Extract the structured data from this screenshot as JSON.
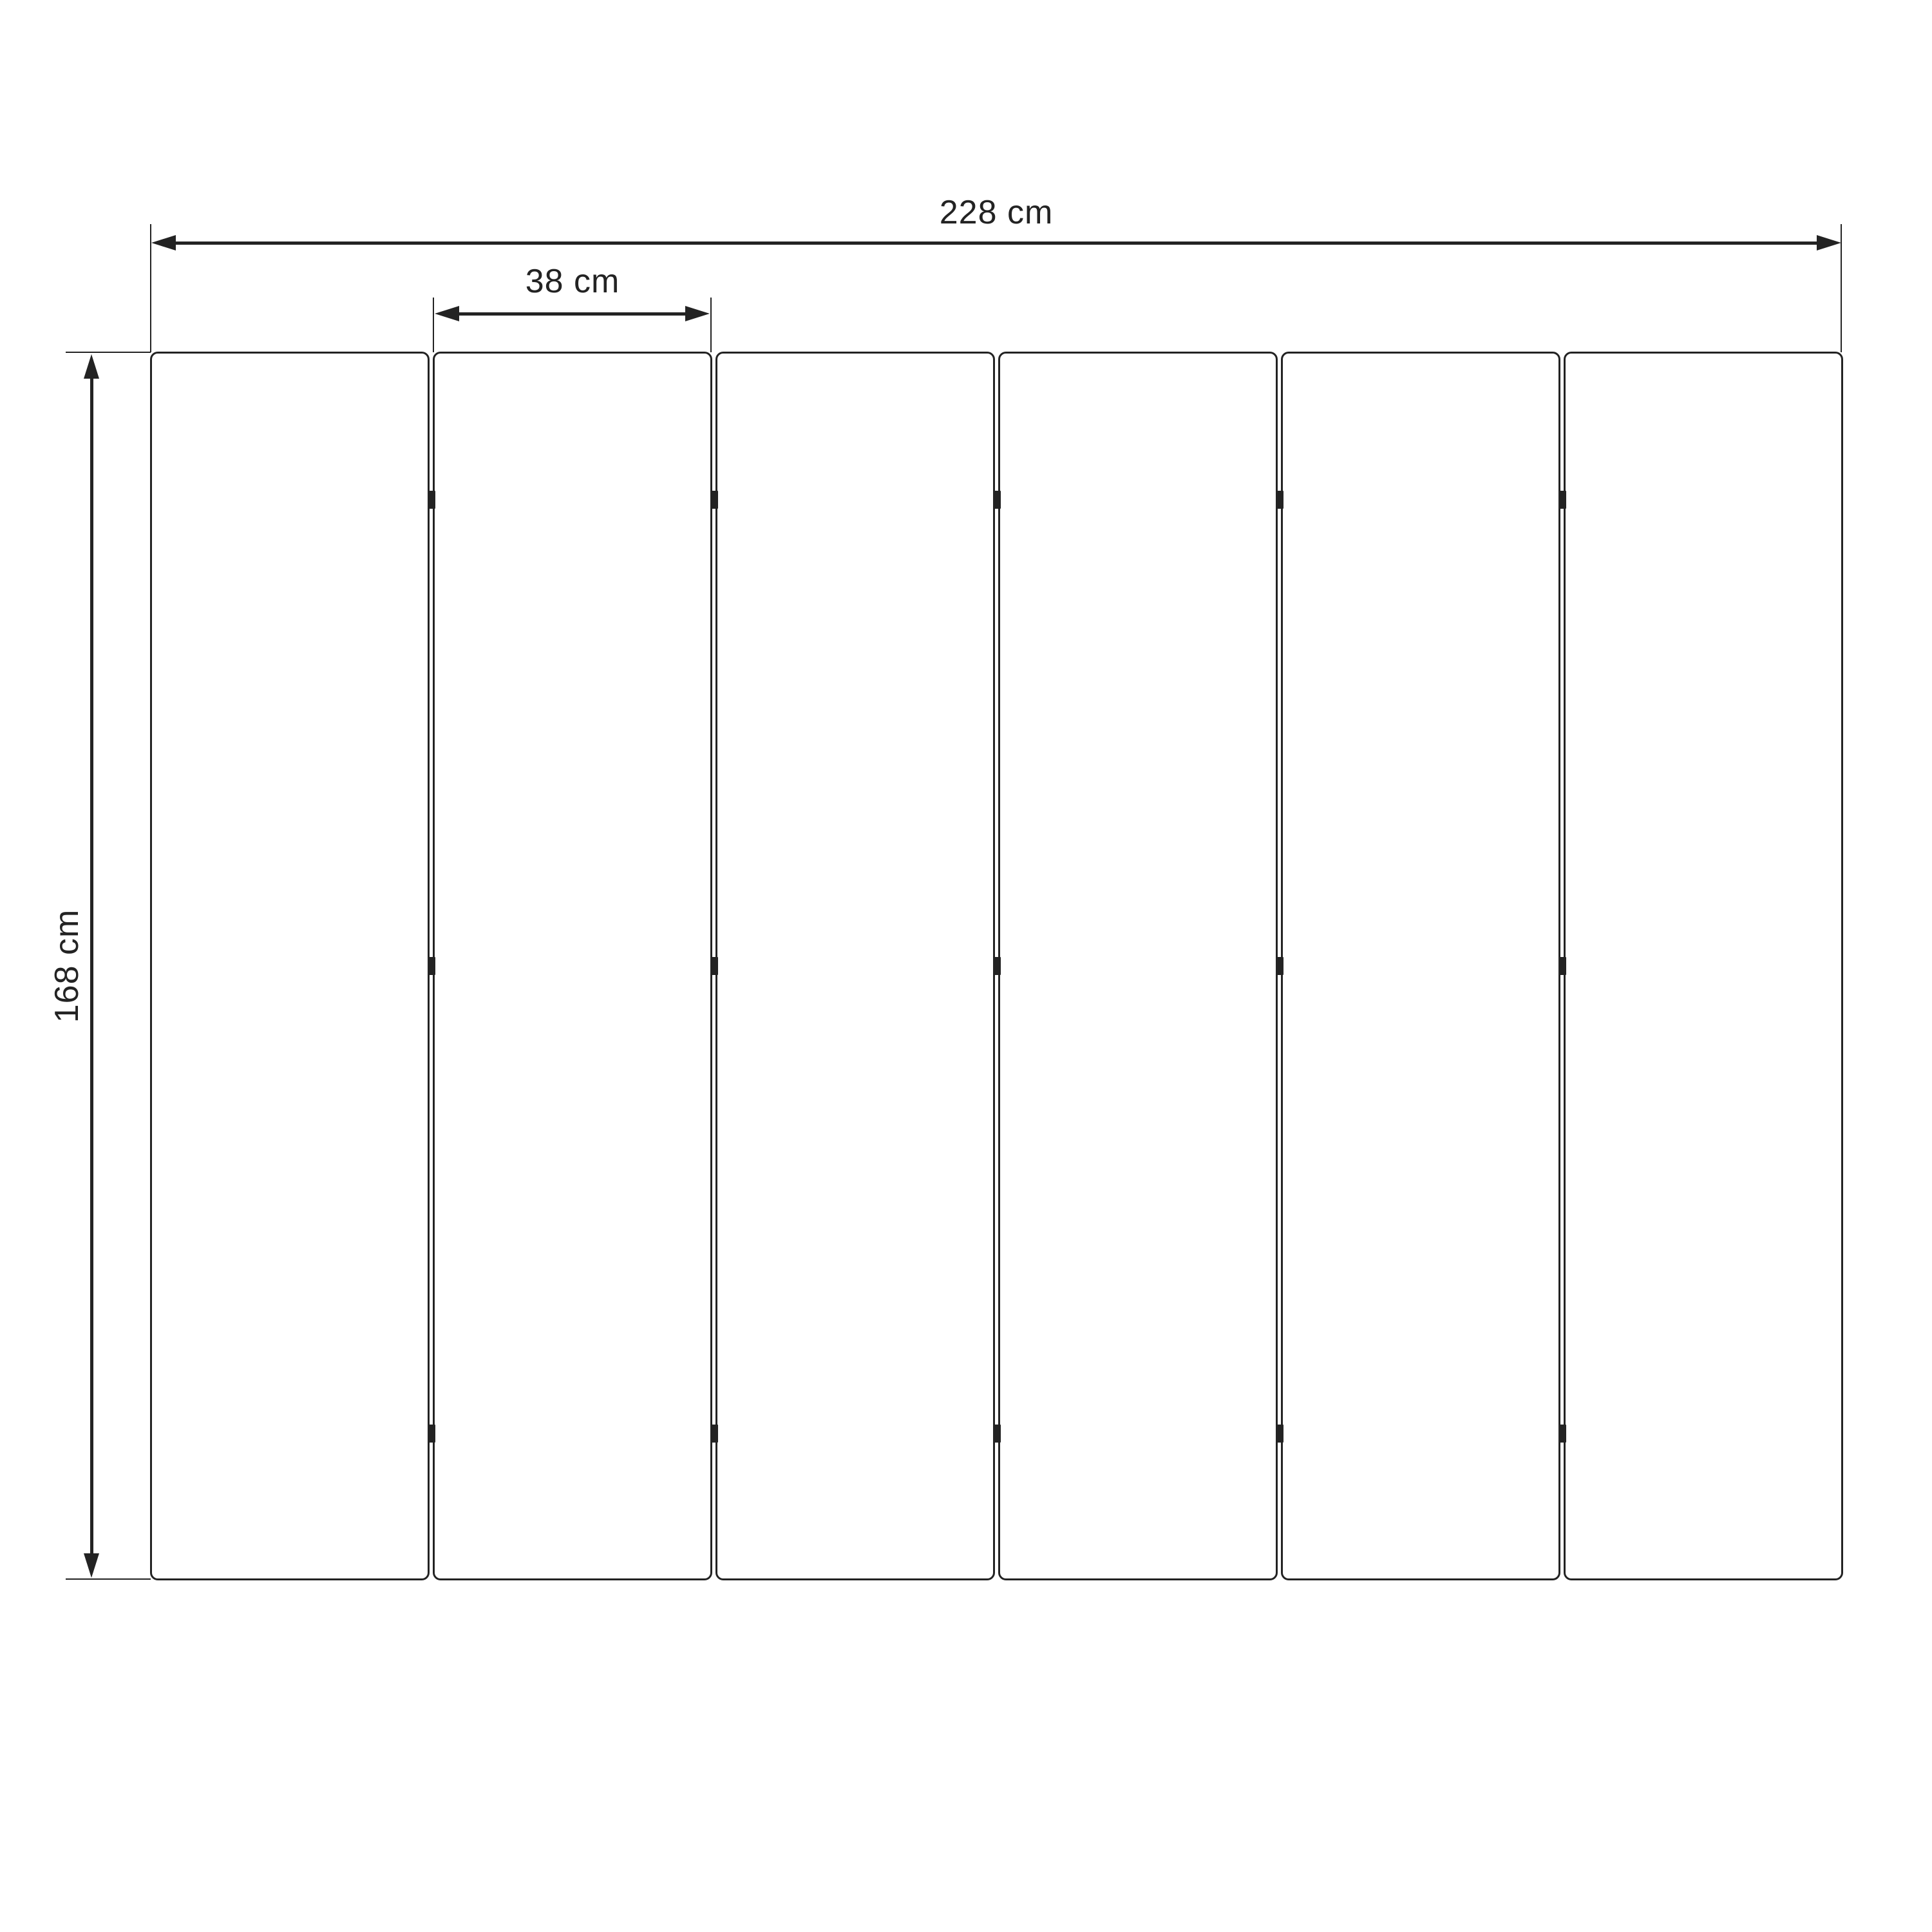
{
  "diagram": {
    "type": "technical-dimension-drawing",
    "background_color": "#ffffff",
    "line_color": "#232323",
    "text_color": "#232323",
    "panel_count": 6,
    "hinge_rows_per_gap": 3,
    "dimensions": {
      "total_width": {
        "label": "228 cm"
      },
      "panel_width": {
        "label": "38 cm"
      },
      "height": {
        "label": "168 cm"
      }
    }
  }
}
